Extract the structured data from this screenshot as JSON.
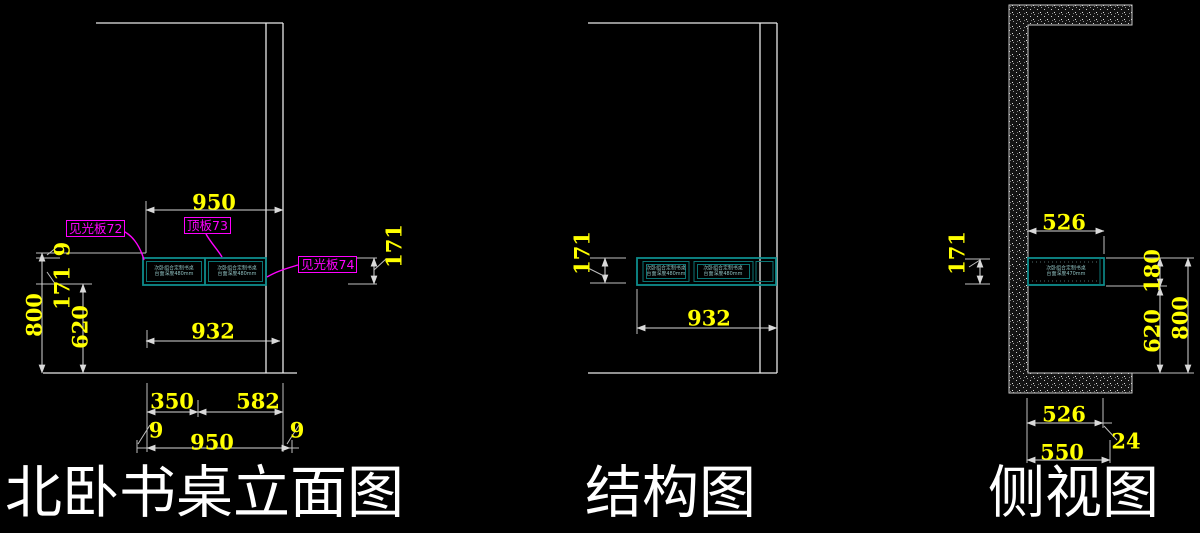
{
  "colors": {
    "background": "#000000",
    "linework": "#e8e8e8",
    "dimension_lines": "#d9d9d9",
    "dimension_text": "#ffff00",
    "component_label": "#ff00ff",
    "cabinet_outline": "#0e8c8c",
    "cabinet_note_text": "#8fc0c0",
    "title_text": "#ffffff",
    "wall_hatch": "#141414"
  },
  "elevation": {
    "title": "北卧书桌立面图",
    "labels": {
      "panel_72": "见光板72",
      "panel_73": "顶板73",
      "panel_74": "见光板74"
    },
    "dims": {
      "top_width": "950",
      "desk_width": "932",
      "total_height": "800",
      "under_height": "620",
      "apron_height_left": "171",
      "top_thickness_left": "9",
      "apron_height_right": "171",
      "seg_350": "350",
      "seg_582": "582",
      "gap_left": "9",
      "bottom_width": "950",
      "gap_right": "9"
    },
    "note": {
      "line1": "次卧组合定制书桌",
      "line2": "台面深度480mm"
    }
  },
  "structure": {
    "title": "结构图",
    "dims": {
      "apron_height": "171",
      "desk_width": "932"
    },
    "note": {
      "line1": "次卧组合定制书桌",
      "line2": "台面深度480mm"
    }
  },
  "side": {
    "title": "侧视图",
    "dims": {
      "top_depth": "526",
      "apron_height": "171",
      "desk_zone": "180",
      "under_height": "620",
      "total_height": "800",
      "bottom_depth": "526",
      "back_panel": "24",
      "overall_depth": "550"
    },
    "note": {
      "line1": "次卧组合定制书桌",
      "line2": "台面深度470mm"
    }
  }
}
